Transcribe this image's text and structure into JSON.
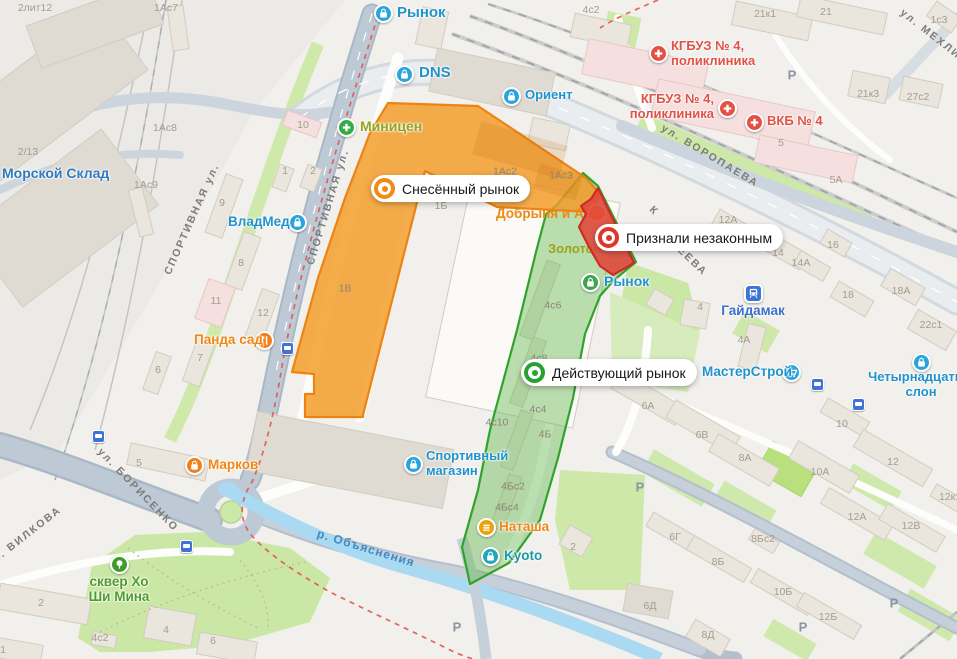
{
  "map": {
    "background": "#f1f0ec",
    "callouts": [
      {
        "name": "demolished-market-callout",
        "text": "Снесённый рынок",
        "color": "#f28a14",
        "x": 371,
        "y": 175
      },
      {
        "name": "illegal-market-callout",
        "text": "Признали незаконным",
        "color": "#e0352b",
        "x": 595,
        "y": 224
      },
      {
        "name": "operating-market-callout",
        "text": "Действующий рынок",
        "color": "#28a22e",
        "x": 521,
        "y": 359
      }
    ],
    "zones": [
      {
        "name": "demolished-market-zone",
        "fill": "#f39a23",
        "opacity": 0.82,
        "stroke": "#ec8312"
      },
      {
        "name": "operating-market-zone",
        "fill": "#5fb54a",
        "opacity": 0.42,
        "stroke": "#2fa32c"
      },
      {
        "name": "illegal-market-zone",
        "fill": "#e0473a",
        "opacity": 0.88,
        "stroke": "#ce2b22"
      }
    ],
    "pois": [
      {
        "n": "market-top",
        "icon": "bag",
        "ic": "#2aa5dc",
        "ix": 383,
        "iy": 13,
        "t": "Рынок",
        "x": 397,
        "y": 5,
        "c": "#2093cc",
        "s": 15
      },
      {
        "n": "dns",
        "icon": "bag",
        "ic": "#2aa5dc",
        "ix": 404,
        "iy": 74,
        "t": "DNS",
        "x": 419,
        "y": 65,
        "c": "#2093cc",
        "s": 15
      },
      {
        "n": "orient",
        "icon": "bag",
        "ic": "#2aa5dc",
        "ix": 511,
        "iy": 96,
        "t": "Ориент",
        "x": 525,
        "y": 88,
        "c": "#2093cc",
        "s": 13
      },
      {
        "n": "vladmed",
        "icon": "bag",
        "ic": "#2aa5dc",
        "ix": 297,
        "iy": 222,
        "t": "ВладМед",
        "x": 228,
        "y": 214,
        "c": "#2093cc",
        "s": 13.5
      },
      {
        "n": "sport-store",
        "icon": "bag",
        "ic": "#2aa5dc",
        "ix": 413,
        "iy": 464,
        "lines": [
          "Спортивный",
          "магазин"
        ],
        "x": 426,
        "y": 449,
        "c": "#2093cc",
        "s": 13
      },
      {
        "n": "fourteenth-slon",
        "icon": "bag",
        "ic": "#2aa5dc",
        "ix": 921,
        "iy": 362,
        "lines": [
          "Четырнадцатый",
          "слон"
        ],
        "x": 921,
        "y": 370,
        "align": "center",
        "c": "#2093cc",
        "s": 13
      },
      {
        "n": "gaydamak-station",
        "icon": "train",
        "ic": "#3d74d8",
        "ix": 753,
        "iy": 293,
        "t": "Гайдамак",
        "x": 753,
        "y": 303,
        "align": "center",
        "c": "#3a70c8",
        "s": 13.5
      },
      {
        "n": "masterstroy",
        "icon": "cart",
        "ic": "#2aa5dc",
        "ix": 791,
        "iy": 372,
        "t": "МастерСтрой",
        "x": 702,
        "y": 364,
        "c": "#2093cc",
        "s": 13.5
      },
      {
        "n": "kyoto",
        "icon": "bag",
        "ic": "#22a7b6",
        "ix": 490,
        "iy": 556,
        "t": "Kyoto",
        "x": 504,
        "y": 548,
        "c": "#1b98a8",
        "s": 13.5
      },
      {
        "n": "market-center",
        "icon": "bag",
        "ic": "#3aa54f",
        "ix": 590,
        "iy": 282,
        "t": "Рынок",
        "x": 604,
        "y": 274,
        "c": "#2093cc",
        "s": 14
      },
      {
        "n": "morskoy-sklad",
        "t": "Морской Склад",
        "x": 2,
        "y": 166,
        "c": "#3179bd",
        "s": 14
      },
      {
        "n": "minitsen",
        "icon": "cross",
        "ic": "#35ab47",
        "ix": 346,
        "iy": 127,
        "t": "Миницен",
        "x": 360,
        "y": 119,
        "c": "#96a31f",
        "s": 14
      },
      {
        "n": "panda-sad",
        "icon": "fork",
        "ic": "#f08019",
        "ix": 264,
        "iy": 340,
        "t": "Панда сад",
        "x": 194,
        "y": 332,
        "c": "#ef8812",
        "s": 13.5
      },
      {
        "n": "markov",
        "icon": "bag",
        "ic": "#f08019",
        "ix": 194,
        "iy": 465,
        "t": "Марков",
        "x": 208,
        "y": 457,
        "c": "#ef8812",
        "s": 13.5
      },
      {
        "n": "natasha",
        "icon": "burger",
        "ic": "#eda20b",
        "ix": 486,
        "iy": 527,
        "t": "Наташа",
        "x": 499,
        "y": 519,
        "c": "#ef8812",
        "s": 13.5
      },
      {
        "n": "ho-chi-minh-park",
        "icon": "tree",
        "ic": "#3f9c28",
        "ix": 119,
        "iy": 564,
        "lines": [
          "сквер Хо",
          "Ши Мина"
        ],
        "x": 119,
        "y": 574,
        "align": "center",
        "c": "#4f9b2d",
        "s": 13.5
      },
      {
        "n": "kgbuz-4-upper",
        "icon": "cross",
        "ic": "#e35045",
        "ix": 658,
        "iy": 53,
        "lines": [
          "КГБУЗ № 4,",
          "поликлиника"
        ],
        "x": 671,
        "y": 39,
        "c": "#e05247",
        "s": 13
      },
      {
        "n": "kgbuz-4-lower",
        "icon": "cross",
        "ic": "#e35045",
        "ix": 727,
        "iy": 108,
        "lines": [
          "КГБУЗ № 4,",
          "поликлиника"
        ],
        "x": 714,
        "y": 92,
        "align": "right",
        "c": "#e05247",
        "s": 13
      },
      {
        "n": "vkb-4",
        "icon": "cross",
        "ic": "#e35045",
        "ix": 754,
        "iy": 122,
        "t": "ВКБ № 4",
        "x": 767,
        "y": 114,
        "c": "#e05247",
        "s": 13
      }
    ],
    "under_pois": [
      {
        "n": "dobrynya-i-anya",
        "t": "Добрыня и Аня",
        "x": 496,
        "y": 218,
        "c": "#ef8812",
        "s": 13.5,
        "circle": [
          597,
          213
        ]
      },
      {
        "n": "zolotoy",
        "t": "Золотой",
        "x": 548,
        "y": 253,
        "c": "#9aa41b",
        "s": 13
      }
    ],
    "street_labels": [
      {
        "t": "СПОРТИВНАЯ ул.",
        "x": 192,
        "y": 219,
        "r": -66
      },
      {
        "t": "СПОРТИВНАЯ ул.",
        "x": 328,
        "y": 207,
        "r": -73
      },
      {
        "t": "ул. БОРИСЕНКО",
        "x": 138,
        "y": 490,
        "r": 46
      },
      {
        "t": "ул. ВИЛКОВА",
        "x": 24,
        "y": 537,
        "r": -38
      },
      {
        "t": "ул. ВОРОПАЕВА",
        "x": 710,
        "y": 156,
        "r": 31
      },
      {
        "t": "ул. МЕХЛИСА",
        "x": 938,
        "y": 40,
        "r": 38
      },
      {
        "t": "ДЕЕВА",
        "x": 689,
        "y": 258,
        "r": 44
      },
      {
        "t": "К",
        "x": 654,
        "y": 211,
        "r": 44
      }
    ],
    "water_label": {
      "t": "р. Объяснения",
      "x": 366,
      "y": 548,
      "r": 17
    },
    "house_numbers": [
      {
        "t": "2лит12",
        "x": 35,
        "y": 8
      },
      {
        "t": "1Ас7",
        "x": 166,
        "y": 8
      },
      {
        "t": "4с2",
        "x": 591,
        "y": 10
      },
      {
        "t": "21к1",
        "x": 765,
        "y": 14
      },
      {
        "t": "21",
        "x": 826,
        "y": 12
      },
      {
        "t": "1с3",
        "x": 939,
        "y": 20
      },
      {
        "t": "2/13",
        "x": 28,
        "y": 152
      },
      {
        "t": "1Ас8",
        "x": 165,
        "y": 128
      },
      {
        "t": "1Ас9",
        "x": 146,
        "y": 185
      },
      {
        "t": "10",
        "x": 303,
        "y": 125
      },
      {
        "t": "1",
        "x": 285,
        "y": 171
      },
      {
        "t": "2",
        "x": 313,
        "y": 171
      },
      {
        "t": "9",
        "x": 222,
        "y": 203
      },
      {
        "t": "8",
        "x": 241,
        "y": 263
      },
      {
        "t": "11",
        "x": 216,
        "y": 301
      },
      {
        "t": "12",
        "x": 263,
        "y": 313
      },
      {
        "t": "7",
        "x": 200,
        "y": 358
      },
      {
        "t": "6",
        "x": 158,
        "y": 370
      },
      {
        "t": "5",
        "x": 139,
        "y": 463
      },
      {
        "t": "1Б",
        "x": 441,
        "y": 206
      },
      {
        "t": "1Ас2",
        "x": 505,
        "y": 171,
        "u": 1
      },
      {
        "t": "1Ас3",
        "x": 561,
        "y": 175,
        "u": 1
      },
      {
        "t": "1В",
        "x": 345,
        "y": 288,
        "u": 1
      },
      {
        "t": "27с2",
        "x": 918,
        "y": 97
      },
      {
        "t": "21к3",
        "x": 868,
        "y": 94
      },
      {
        "t": "5",
        "x": 781,
        "y": 143
      },
      {
        "t": "5А",
        "x": 836,
        "y": 180
      },
      {
        "t": "12А",
        "x": 728,
        "y": 220
      },
      {
        "t": "14",
        "x": 778,
        "y": 253
      },
      {
        "t": "14А",
        "x": 801,
        "y": 263
      },
      {
        "t": "16",
        "x": 833,
        "y": 245
      },
      {
        "t": "18",
        "x": 848,
        "y": 295
      },
      {
        "t": "18А",
        "x": 901,
        "y": 291
      },
      {
        "t": "22с1",
        "x": 931,
        "y": 325
      },
      {
        "t": "4",
        "x": 700,
        "y": 307
      },
      {
        "t": "4А",
        "x": 744,
        "y": 340
      },
      {
        "t": "4с6",
        "x": 553,
        "y": 305,
        "u": 1
      },
      {
        "t": "4с8",
        "x": 539,
        "y": 358,
        "u": 1
      },
      {
        "t": "4с4",
        "x": 538,
        "y": 409,
        "u": 1
      },
      {
        "t": "4с10",
        "x": 497,
        "y": 422,
        "u": 1
      },
      {
        "t": "4Б",
        "x": 545,
        "y": 434,
        "u": 1
      },
      {
        "t": "4Бс2",
        "x": 513,
        "y": 486,
        "u": 1
      },
      {
        "t": "4Бс4",
        "x": 507,
        "y": 507,
        "u": 1
      },
      {
        "t": "6А",
        "x": 648,
        "y": 406
      },
      {
        "t": "6В",
        "x": 702,
        "y": 435
      },
      {
        "t": "8А",
        "x": 745,
        "y": 458
      },
      {
        "t": "10",
        "x": 842,
        "y": 424
      },
      {
        "t": "10А",
        "x": 820,
        "y": 472
      },
      {
        "t": "12",
        "x": 893,
        "y": 462
      },
      {
        "t": "12к1",
        "x": 950,
        "y": 497
      },
      {
        "t": "12А",
        "x": 857,
        "y": 517
      },
      {
        "t": "12В",
        "x": 911,
        "y": 526
      },
      {
        "t": "6Г",
        "x": 675,
        "y": 537
      },
      {
        "t": "8Б",
        "x": 718,
        "y": 562
      },
      {
        "t": "8Бс2",
        "x": 763,
        "y": 539
      },
      {
        "t": "6Д",
        "x": 650,
        "y": 606
      },
      {
        "t": "10Б",
        "x": 783,
        "y": 592
      },
      {
        "t": "12Б",
        "x": 828,
        "y": 617
      },
      {
        "t": "8Д",
        "x": 708,
        "y": 635
      },
      {
        "t": "2",
        "x": 573,
        "y": 547
      },
      {
        "t": "2",
        "x": 41,
        "y": 603
      },
      {
        "t": "1",
        "x": 3,
        "y": 650
      },
      {
        "t": "4с2",
        "x": 100,
        "y": 638
      },
      {
        "t": "4",
        "x": 166,
        "y": 630
      },
      {
        "t": "6",
        "x": 213,
        "y": 641
      }
    ],
    "parking": [
      {
        "x": 792,
        "y": 75
      },
      {
        "x": 640,
        "y": 487
      },
      {
        "x": 457,
        "y": 627
      },
      {
        "x": 803,
        "y": 627
      },
      {
        "x": 894,
        "y": 603
      }
    ],
    "parking_label": "Р",
    "bus_stops": [
      {
        "x": 98,
        "y": 436
      },
      {
        "x": 186,
        "y": 546
      },
      {
        "x": 287,
        "y": 348
      },
      {
        "x": 817,
        "y": 384
      },
      {
        "x": 858,
        "y": 404
      }
    ]
  }
}
